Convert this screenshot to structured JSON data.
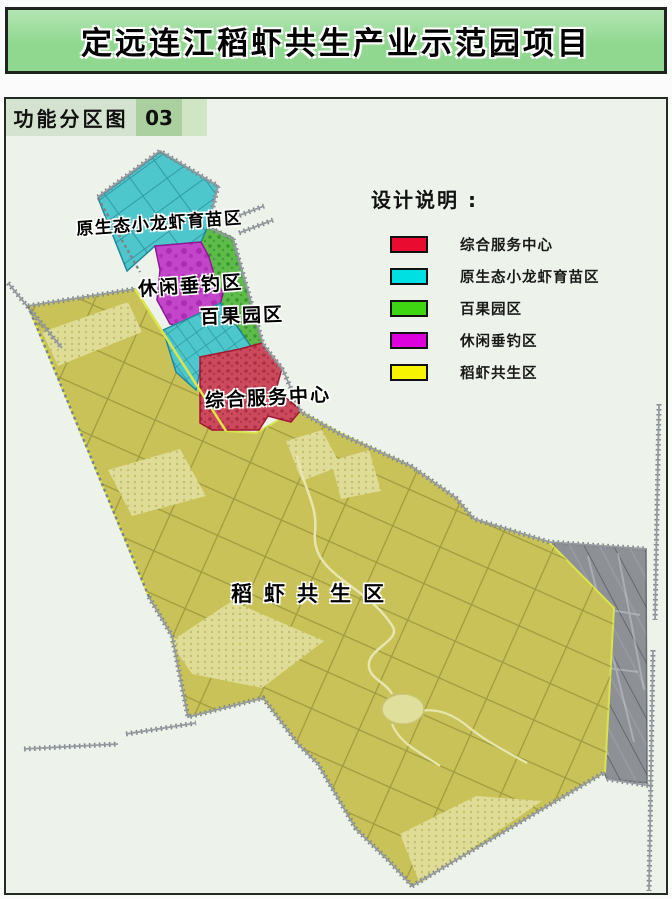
{
  "title": "定远连江稻虾共生产业示范园项目",
  "tag": {
    "label": "功能分区图",
    "number": "03"
  },
  "legend": {
    "title": "设计说明 :",
    "items": [
      {
        "label": "综合服务中心",
        "color": "#ea0c30"
      },
      {
        "label": "原生态小龙虾育苗区",
        "color": "#00dfe2"
      },
      {
        "label": "百果园区",
        "color": "#3fd513"
      },
      {
        "label": "休闲垂钓区",
        "color": "#dd02dd"
      },
      {
        "label": "稻虾共生区",
        "color": "#f7f400"
      }
    ]
  },
  "map_labels": [
    {
      "text": "原生态小龙虾育苗区"
    },
    {
      "text": "休闲垂钓区"
    },
    {
      "text": "百果园区"
    },
    {
      "text": "综合服务中心"
    },
    {
      "text": "稻虾共生区"
    }
  ],
  "colors": {
    "title_green": "#90d890",
    "panel_bg": "#edf3ea",
    "tag_bg": "#d4e3cf",
    "tag_number_bg": "#abd09f",
    "tag_spacer_bg": "#cfe5c3",
    "rice_shrimp": "#c8c258",
    "crayfish_nursery": "#4ec7cc",
    "orchard": "#5dbb49",
    "leisure_fishing": "#c345c9",
    "service_center": "#cd4a5c",
    "outside_area": "#8d9196"
  }
}
